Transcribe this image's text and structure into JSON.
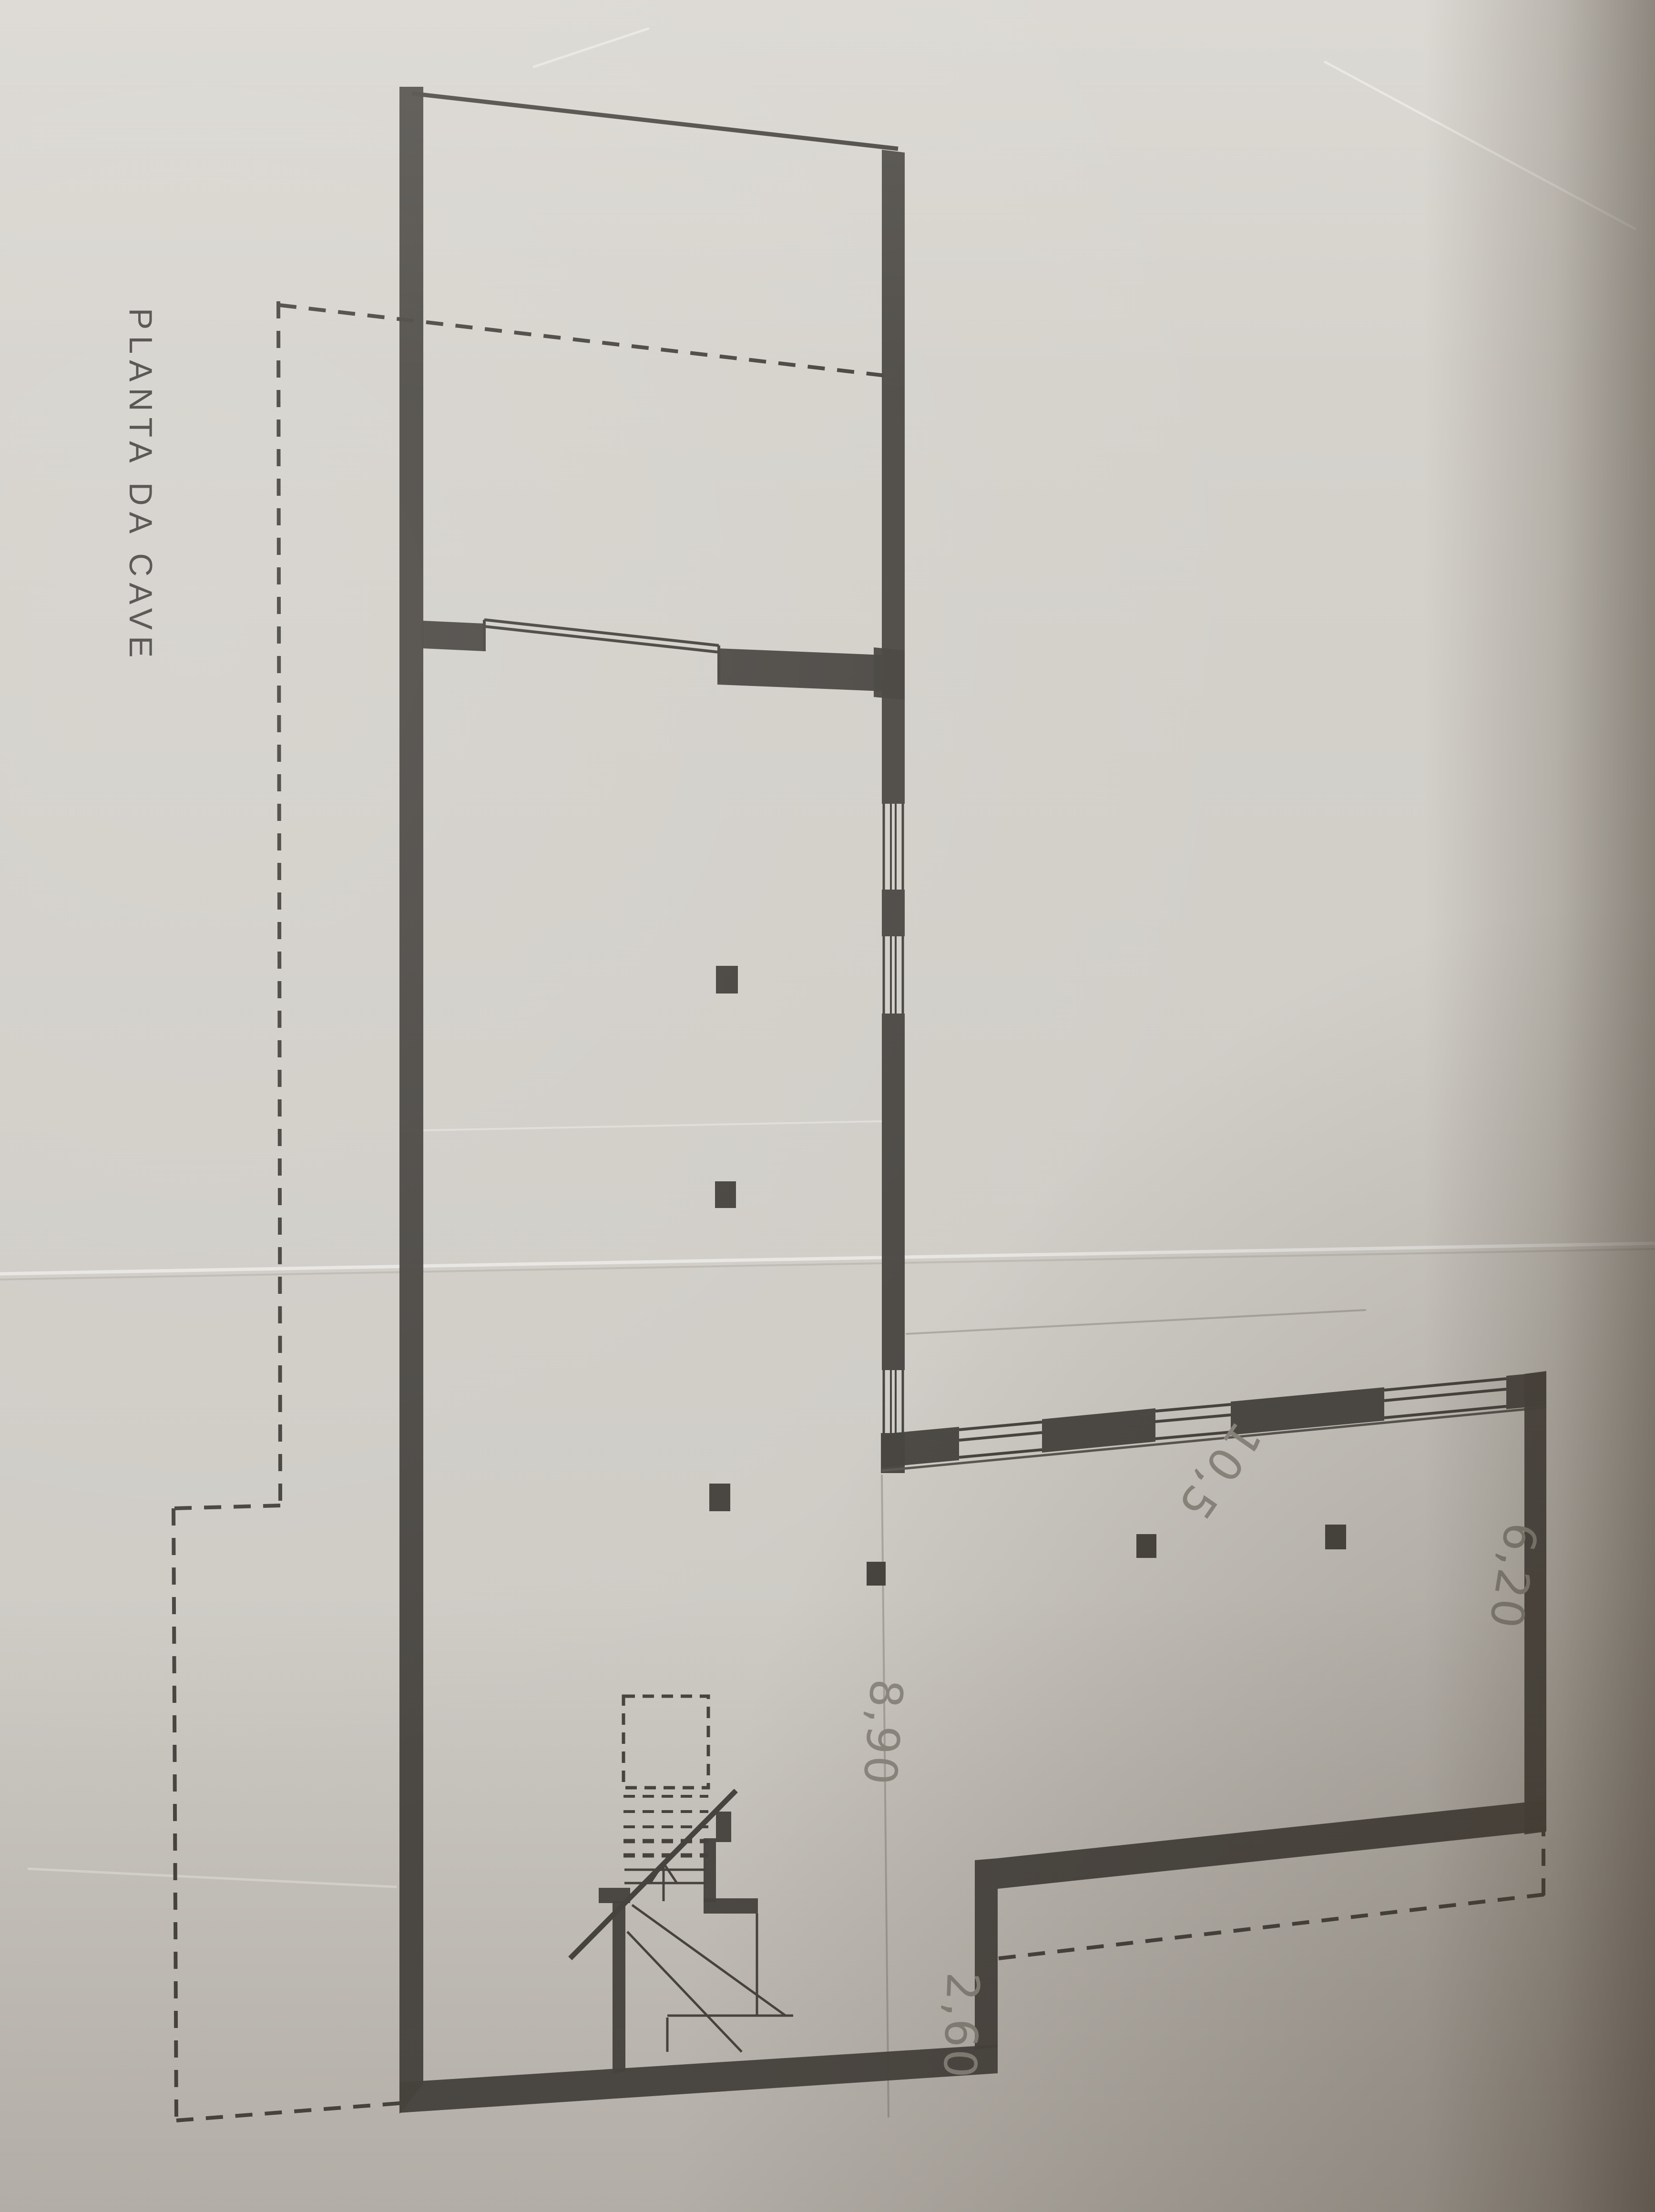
{
  "title": {
    "text": "PLANTA DA CAVE"
  },
  "dimensions": {
    "wing_width": {
      "text": "10,5"
    },
    "stair_depth": {
      "text": "8,90"
    },
    "setback_depth": {
      "text": "2,60"
    },
    "wing_depth": {
      "text": "6,20"
    }
  },
  "colors": {
    "paper": "#d3d0ca",
    "ink": "#47443f",
    "pencil": "#8f8c84",
    "shadow": "#6b6254"
  }
}
